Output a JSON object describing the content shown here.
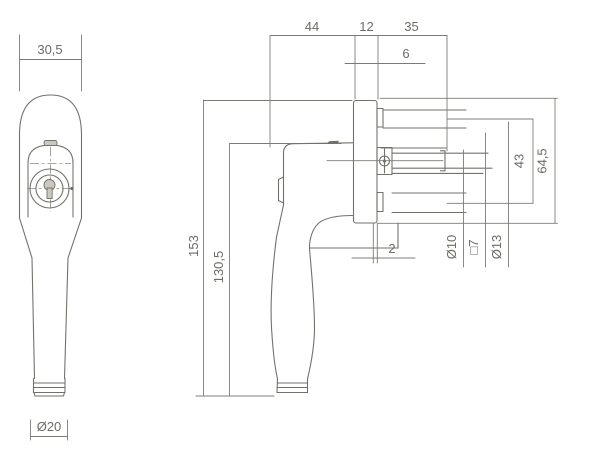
{
  "drawing": {
    "colors": {
      "line": "#72726c",
      "dimension_line": "#7c7c76",
      "text": "#6b6b66",
      "background": "#ffffff"
    },
    "dimensions": {
      "head_width": "30,5",
      "arm_length": "44",
      "rosette_thickness": "12",
      "spindle_length": "35",
      "cap_offset": "6",
      "total_height": "153",
      "grip_length": "130,5",
      "screw_spacing": "43",
      "rosette_height": "64,5",
      "plate_gap": "2",
      "screw_hole_diameter": "Ø10",
      "spindle_square": "□7",
      "collar_diameter": "Ø13",
      "grip_diameter": "Ø20"
    }
  }
}
